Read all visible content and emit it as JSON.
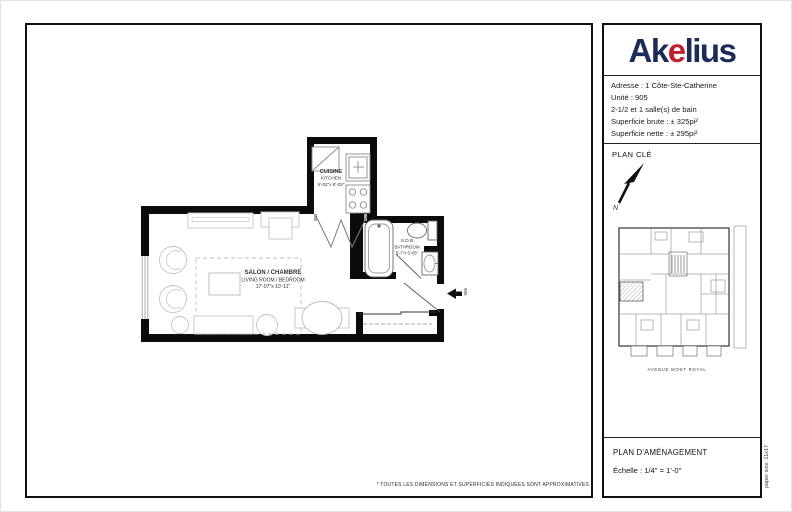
{
  "logo": {
    "part1": "Ak",
    "accent": "e",
    "part2": "lius"
  },
  "colors": {
    "logo_navy": "#1d2b5a",
    "logo_red": "#c01f2d",
    "wall": "#0b0b0b",
    "furniture": "#c4c4c4"
  },
  "sidebar": {
    "info": {
      "address": "Adresse : 1 Côte-Ste-Catherine",
      "unit": "Unité : 905",
      "rooms_baths": "2-1/2 et 1 salle(s) de bain",
      "gross_area": "Superficie brute : ± 325pi²",
      "net_area": "Superficie nette : ± 295pi²"
    },
    "key_plan": {
      "title": "PLAN CLÉ",
      "north_label": "N",
      "street_label": "AVENUE MONT ROYAL"
    },
    "footer": {
      "title": "PLAN D'AMÉNAGEMENT",
      "scale": "Échelle : 1/4\" = 1'-0\""
    }
  },
  "floorplan": {
    "kitchen": {
      "label_fr": "CUISINE",
      "label_en": "KITCHEN",
      "dimensions": "5'-02\"x 6'-03\""
    },
    "living_room": {
      "label_fr": "SALON / CHAMBRE",
      "label_en": "LIVING ROOM / BEDROOM",
      "dimensions": "17'-07\"x 10'-11\""
    },
    "bathroom": {
      "label_fr": "S.D.B",
      "label_en": "BATHROOM",
      "dimensions": "5'-7\"x 5'-05\""
    },
    "unit_number": "905"
  },
  "disclaimer": "* TOUTES LES DIMENSIONS ET SUPERFICIES INDIQUÉES SONT APPROXIMATIVES",
  "paper_size_note": "paper size: 11x17"
}
